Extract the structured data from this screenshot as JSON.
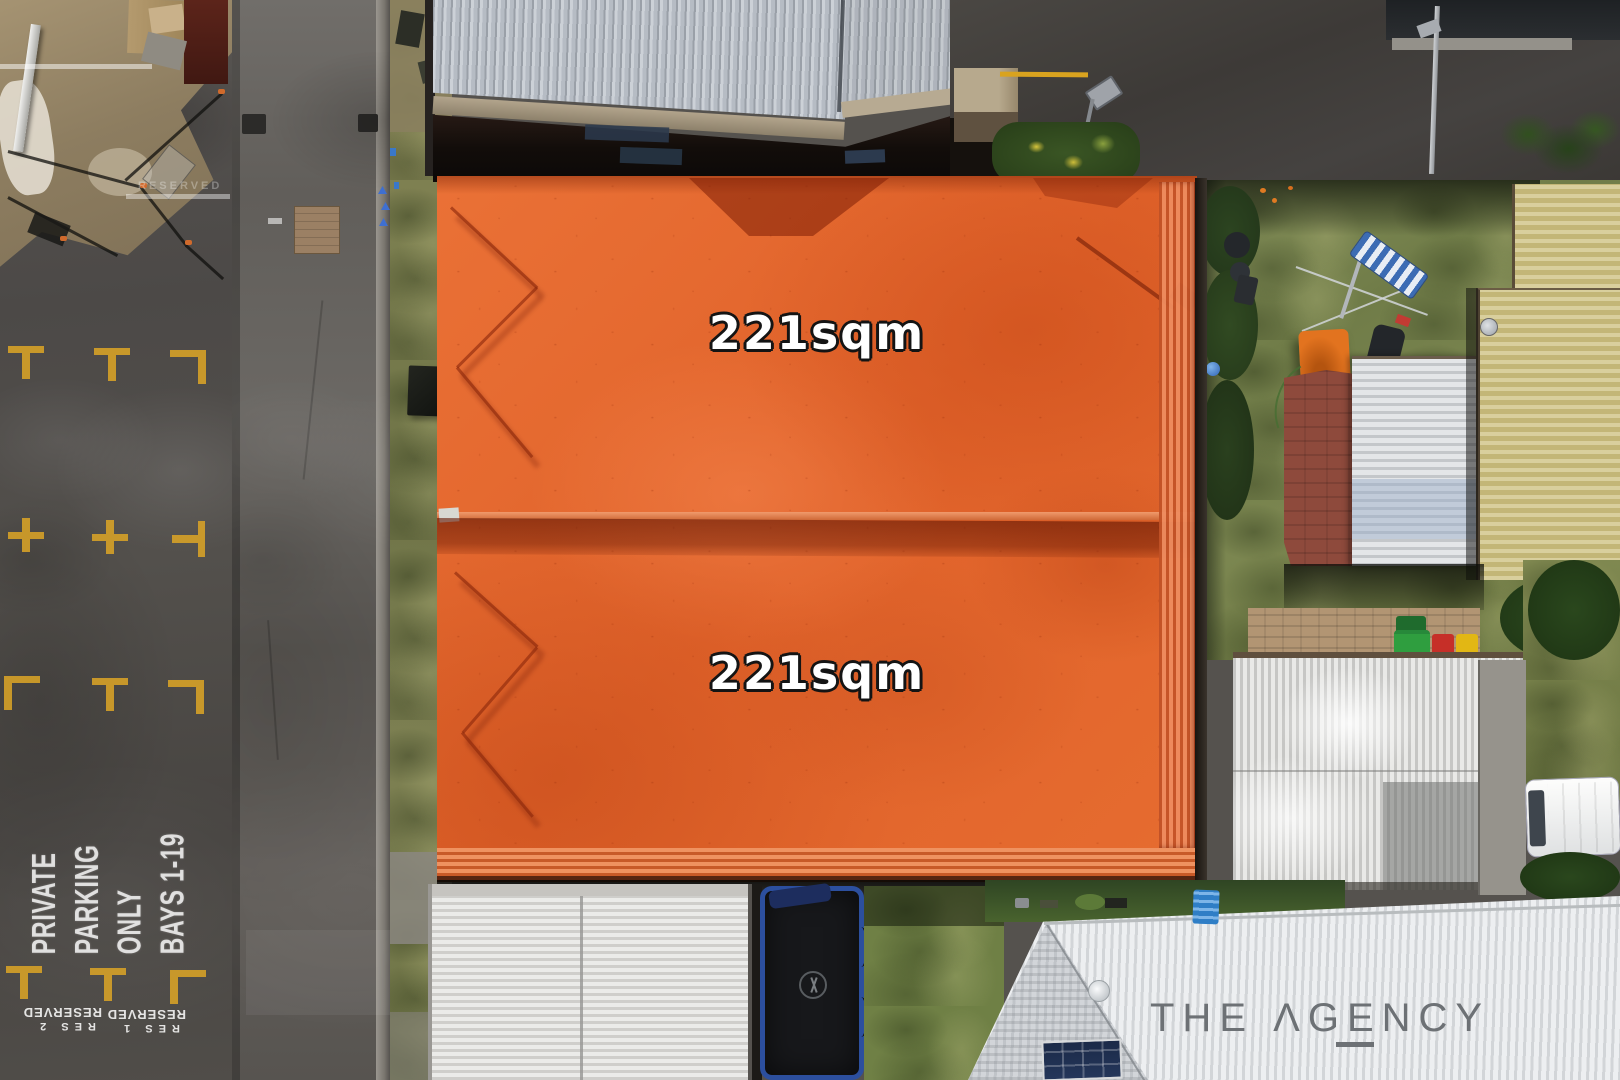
{
  "scene": {
    "description": "Aerial drone photograph of two vacant land lots highlighted in orange for a real estate listing",
    "lot_overlay_color": "#e4672b"
  },
  "lots": [
    {
      "name": "rear-lot",
      "area_label": "221sqm"
    },
    {
      "name": "front-lot",
      "area_label": "221sqm"
    }
  ],
  "ground_markings": {
    "private_parking_sign": {
      "lines": [
        "PRIVATE",
        "PARKING",
        "ONLY",
        "BAYS 1-19"
      ]
    },
    "reserved_bay_2": {
      "bay": "RES 2",
      "text": "RESERVED"
    },
    "reserved_bay_1": {
      "bay": "RES 1",
      "text": "RESERVED"
    },
    "faded_marking": "RESERVED"
  },
  "branding": {
    "logo_text": "THE ΛGENCY",
    "logo_color": "#6d7175"
  },
  "colors": {
    "lot_fill": "#e4672b",
    "bay_marker_yellow": "#d9a327",
    "asphalt": "#4e4b48",
    "grass": "#7d8852",
    "label_text": "#ffffff",
    "label_outline": "#141414"
  }
}
